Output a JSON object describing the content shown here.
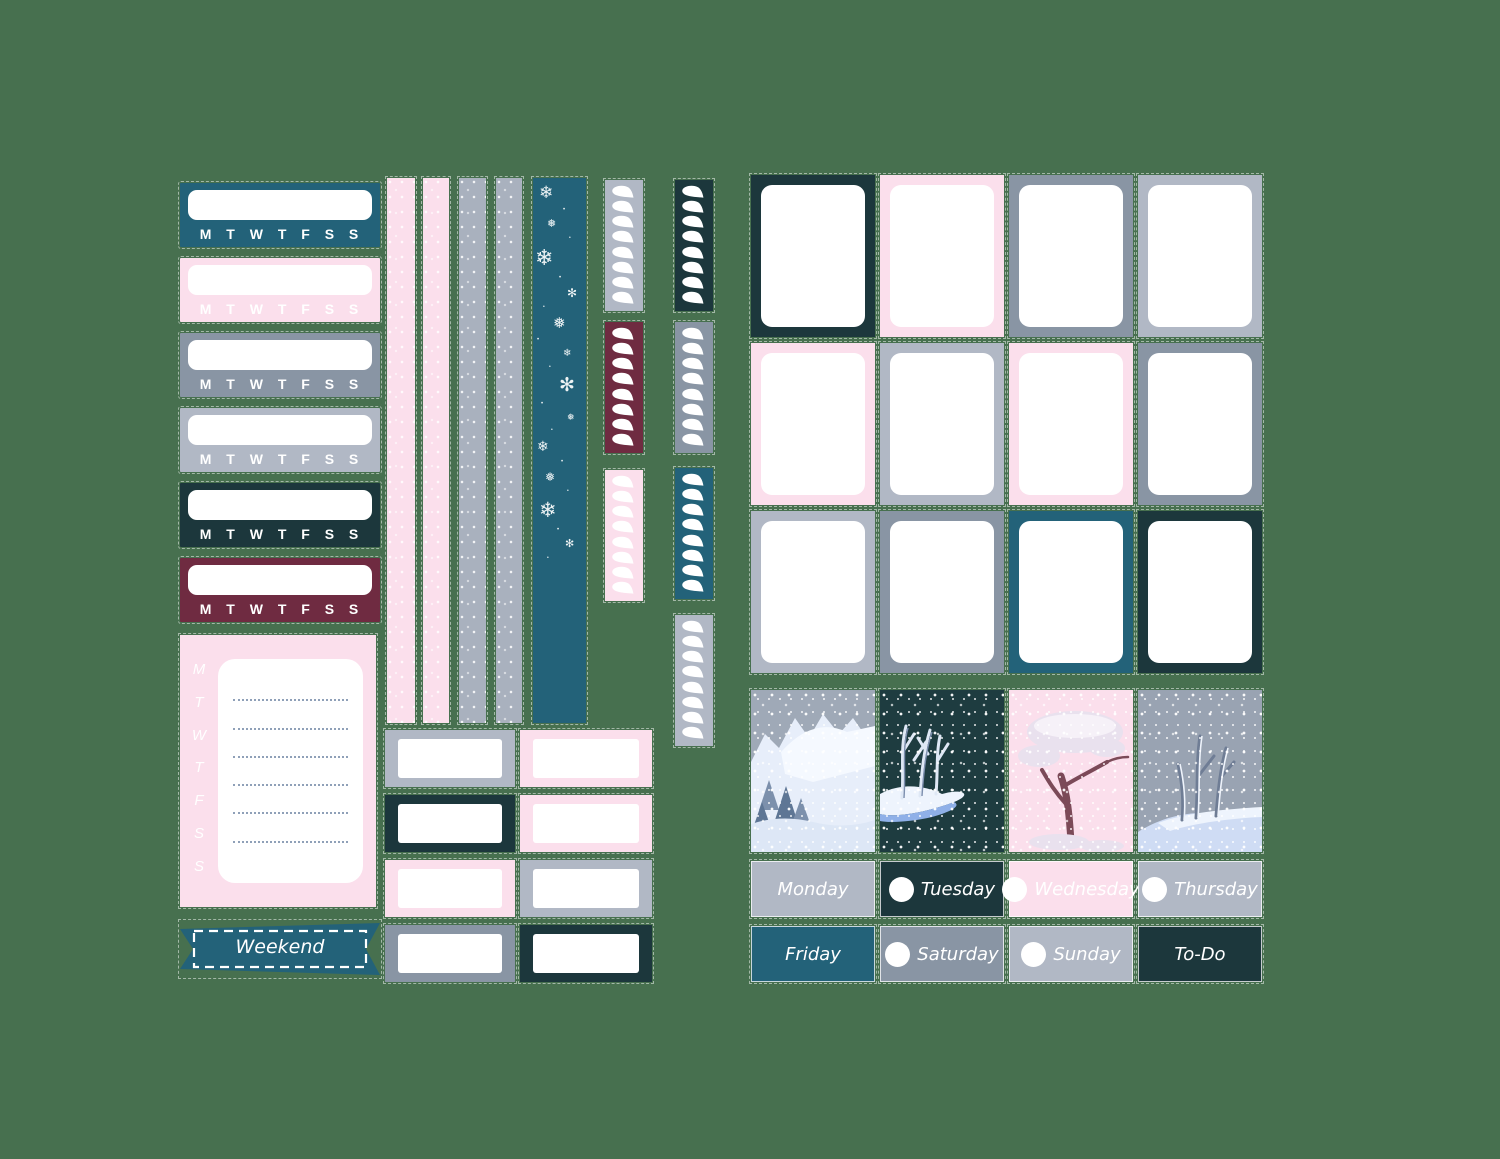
{
  "canvas": {
    "background": "#47704f"
  },
  "palette": {
    "teal": "#236279",
    "navy": "#1c373c",
    "pink": "#fbdfec",
    "light_gray": "#b1b8c5",
    "gray_blue": "#8995a4",
    "burgundy": "#6f2b41",
    "washi_gray": "#a9b1be",
    "white": "#ffffff"
  },
  "date_covers": {
    "days_label": "M T W T F S S",
    "items": [
      {
        "color_key": "teal"
      },
      {
        "color_key": "pink"
      },
      {
        "color_key": "gray_blue"
      },
      {
        "color_key": "light_gray"
      },
      {
        "color_key": "navy"
      },
      {
        "color_key": "burgundy"
      }
    ]
  },
  "notes_sticker": {
    "day_letters": [
      "M",
      "T",
      "W",
      "T",
      "F",
      "S",
      "S"
    ],
    "line_count": 6,
    "background_key": "pink"
  },
  "weekend_banner": {
    "label": "Weekend",
    "color_key": "teal"
  },
  "washi_strips": [
    {
      "pattern": "speckle",
      "color_key": "pink"
    },
    {
      "pattern": "speckle",
      "color_key": "pink"
    },
    {
      "pattern": "speckle",
      "color_key": "washi_gray"
    },
    {
      "pattern": "speckle",
      "color_key": "washi_gray"
    },
    {
      "pattern": "snowflakes",
      "color_key": "teal"
    }
  ],
  "snowflake_glyphs": [
    "❄",
    "❅",
    "✻",
    "•"
  ],
  "flag_columns": {
    "flags_per_strip": 8,
    "left": [
      {
        "color_key": "light_gray"
      },
      {
        "color_key": "burgundy"
      },
      {
        "color_key": "pink"
      }
    ],
    "right": [
      {
        "color_key": "navy"
      },
      {
        "color_key": "gray_blue"
      },
      {
        "color_key": "teal"
      },
      {
        "color_key": "light_gray"
      }
    ]
  },
  "small_boxes": {
    "rows": [
      [
        "light_gray",
        "pink"
      ],
      [
        "navy",
        "pink"
      ],
      [
        "pink",
        "light_gray"
      ],
      [
        "gray_blue",
        "navy"
      ]
    ]
  },
  "full_boxes": {
    "rows": [
      [
        "navy",
        "pink",
        "gray_blue",
        "light_gray"
      ],
      [
        "pink",
        "light_gray",
        "pink",
        "gray_blue"
      ],
      [
        "light_gray",
        "gray_blue",
        "teal",
        "navy"
      ]
    ]
  },
  "scene_stickers": [
    {
      "name": "snowy-cliffs",
      "sky": "#9fa9b7"
    },
    {
      "name": "night-snow-forest",
      "sky": "#1e3c40"
    },
    {
      "name": "pink-snow-tree",
      "sky": "#fbdfec"
    },
    {
      "name": "gray-snow-forest",
      "sky": "#99a3b2"
    }
  ],
  "day_labels": {
    "rows": [
      [
        {
          "label": "Monday",
          "color_key": "light_gray",
          "circle": false
        },
        {
          "label": "Tuesday",
          "color_key": "navy",
          "circle": true
        },
        {
          "label": "Wednesday",
          "color_key": "pink",
          "circle": true
        },
        {
          "label": "Thursday",
          "color_key": "light_gray",
          "circle": true
        }
      ],
      [
        {
          "label": "Friday",
          "color_key": "teal",
          "circle": false
        },
        {
          "label": "Saturday",
          "color_key": "gray_blue",
          "circle": true
        },
        {
          "label": "Sunday",
          "color_key": "light_gray",
          "circle": true
        },
        {
          "label": "To-Do",
          "color_key": "navy",
          "circle": false
        }
      ]
    ]
  }
}
